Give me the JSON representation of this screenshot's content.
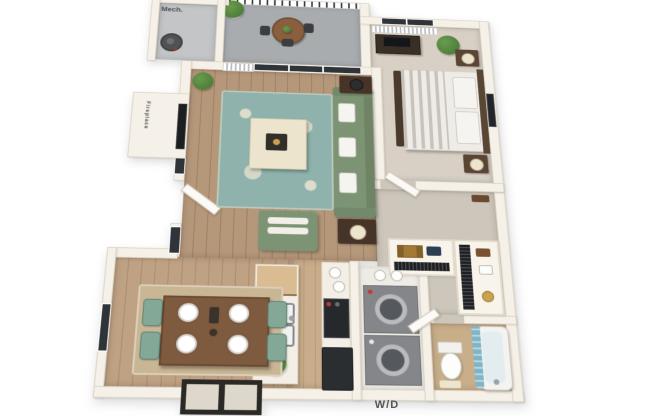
{
  "labels": {
    "mech_room": "Mech.",
    "fireplace": "Fireplace",
    "washer_dryer": "W/D"
  },
  "palette": {
    "wall": "#f6f1e8",
    "wallEdge": "#ddd5c4",
    "wood": "#b5977a",
    "woodDining": "#bfa183",
    "woodK": "#c9ad8b",
    "carpet": "#d8d0c5",
    "carpetHall": "#cdc6ba",
    "balcony": "#a8acaf",
    "mechFloor": "#c3c5c7",
    "rug": "#8fb2ac",
    "rugPattern": "#e7e2cf",
    "sofa": "#7d9474",
    "chairTeal": "#83a898",
    "tableBrown": "#7e5a3e",
    "darkWood": "#473428",
    "cream": "#ece4cc",
    "appliance": "#84868a",
    "curtain": "#7fb5c6",
    "bathTan": "#c9ae8a",
    "plant": "#4e7d3a",
    "plantLight": "#6a9c4e",
    "label": "#4a4a4a"
  },
  "rooms": [
    {
      "name": "mechanical-closet",
      "items": [
        "water-heater"
      ]
    },
    {
      "name": "balcony",
      "items": [
        "railing",
        "round-table",
        "chairs",
        "potted-plant"
      ]
    },
    {
      "name": "living-room",
      "items": [
        "sofa",
        "ottoman",
        "area-rug",
        "accent-chair",
        "side-tables",
        "lamps",
        "fireplace",
        "tv",
        "sliding-glass-door",
        "vertical-blinds",
        "plant"
      ]
    },
    {
      "name": "bedroom",
      "items": [
        "bed",
        "nightstands",
        "lamps",
        "dresser",
        "tv",
        "plant",
        "wall-art",
        "window",
        "blinds"
      ]
    },
    {
      "name": "walk-in-closet",
      "items": [
        "shelves",
        "hanging-clothes",
        "suitcase",
        "bags"
      ]
    },
    {
      "name": "kitchen",
      "items": [
        "island",
        "double-sink",
        "stove",
        "refrigerator",
        "counter",
        "plant"
      ]
    },
    {
      "name": "laundry-closet",
      "items": [
        "washer",
        "dryer"
      ]
    },
    {
      "name": "bathroom",
      "items": [
        "toilet",
        "bathtub",
        "shower-curtain",
        "bath-mat",
        "door"
      ]
    },
    {
      "name": "dining-area",
      "items": [
        "dining-table",
        "plates",
        "chairs",
        "rug",
        "windows"
      ]
    }
  ]
}
